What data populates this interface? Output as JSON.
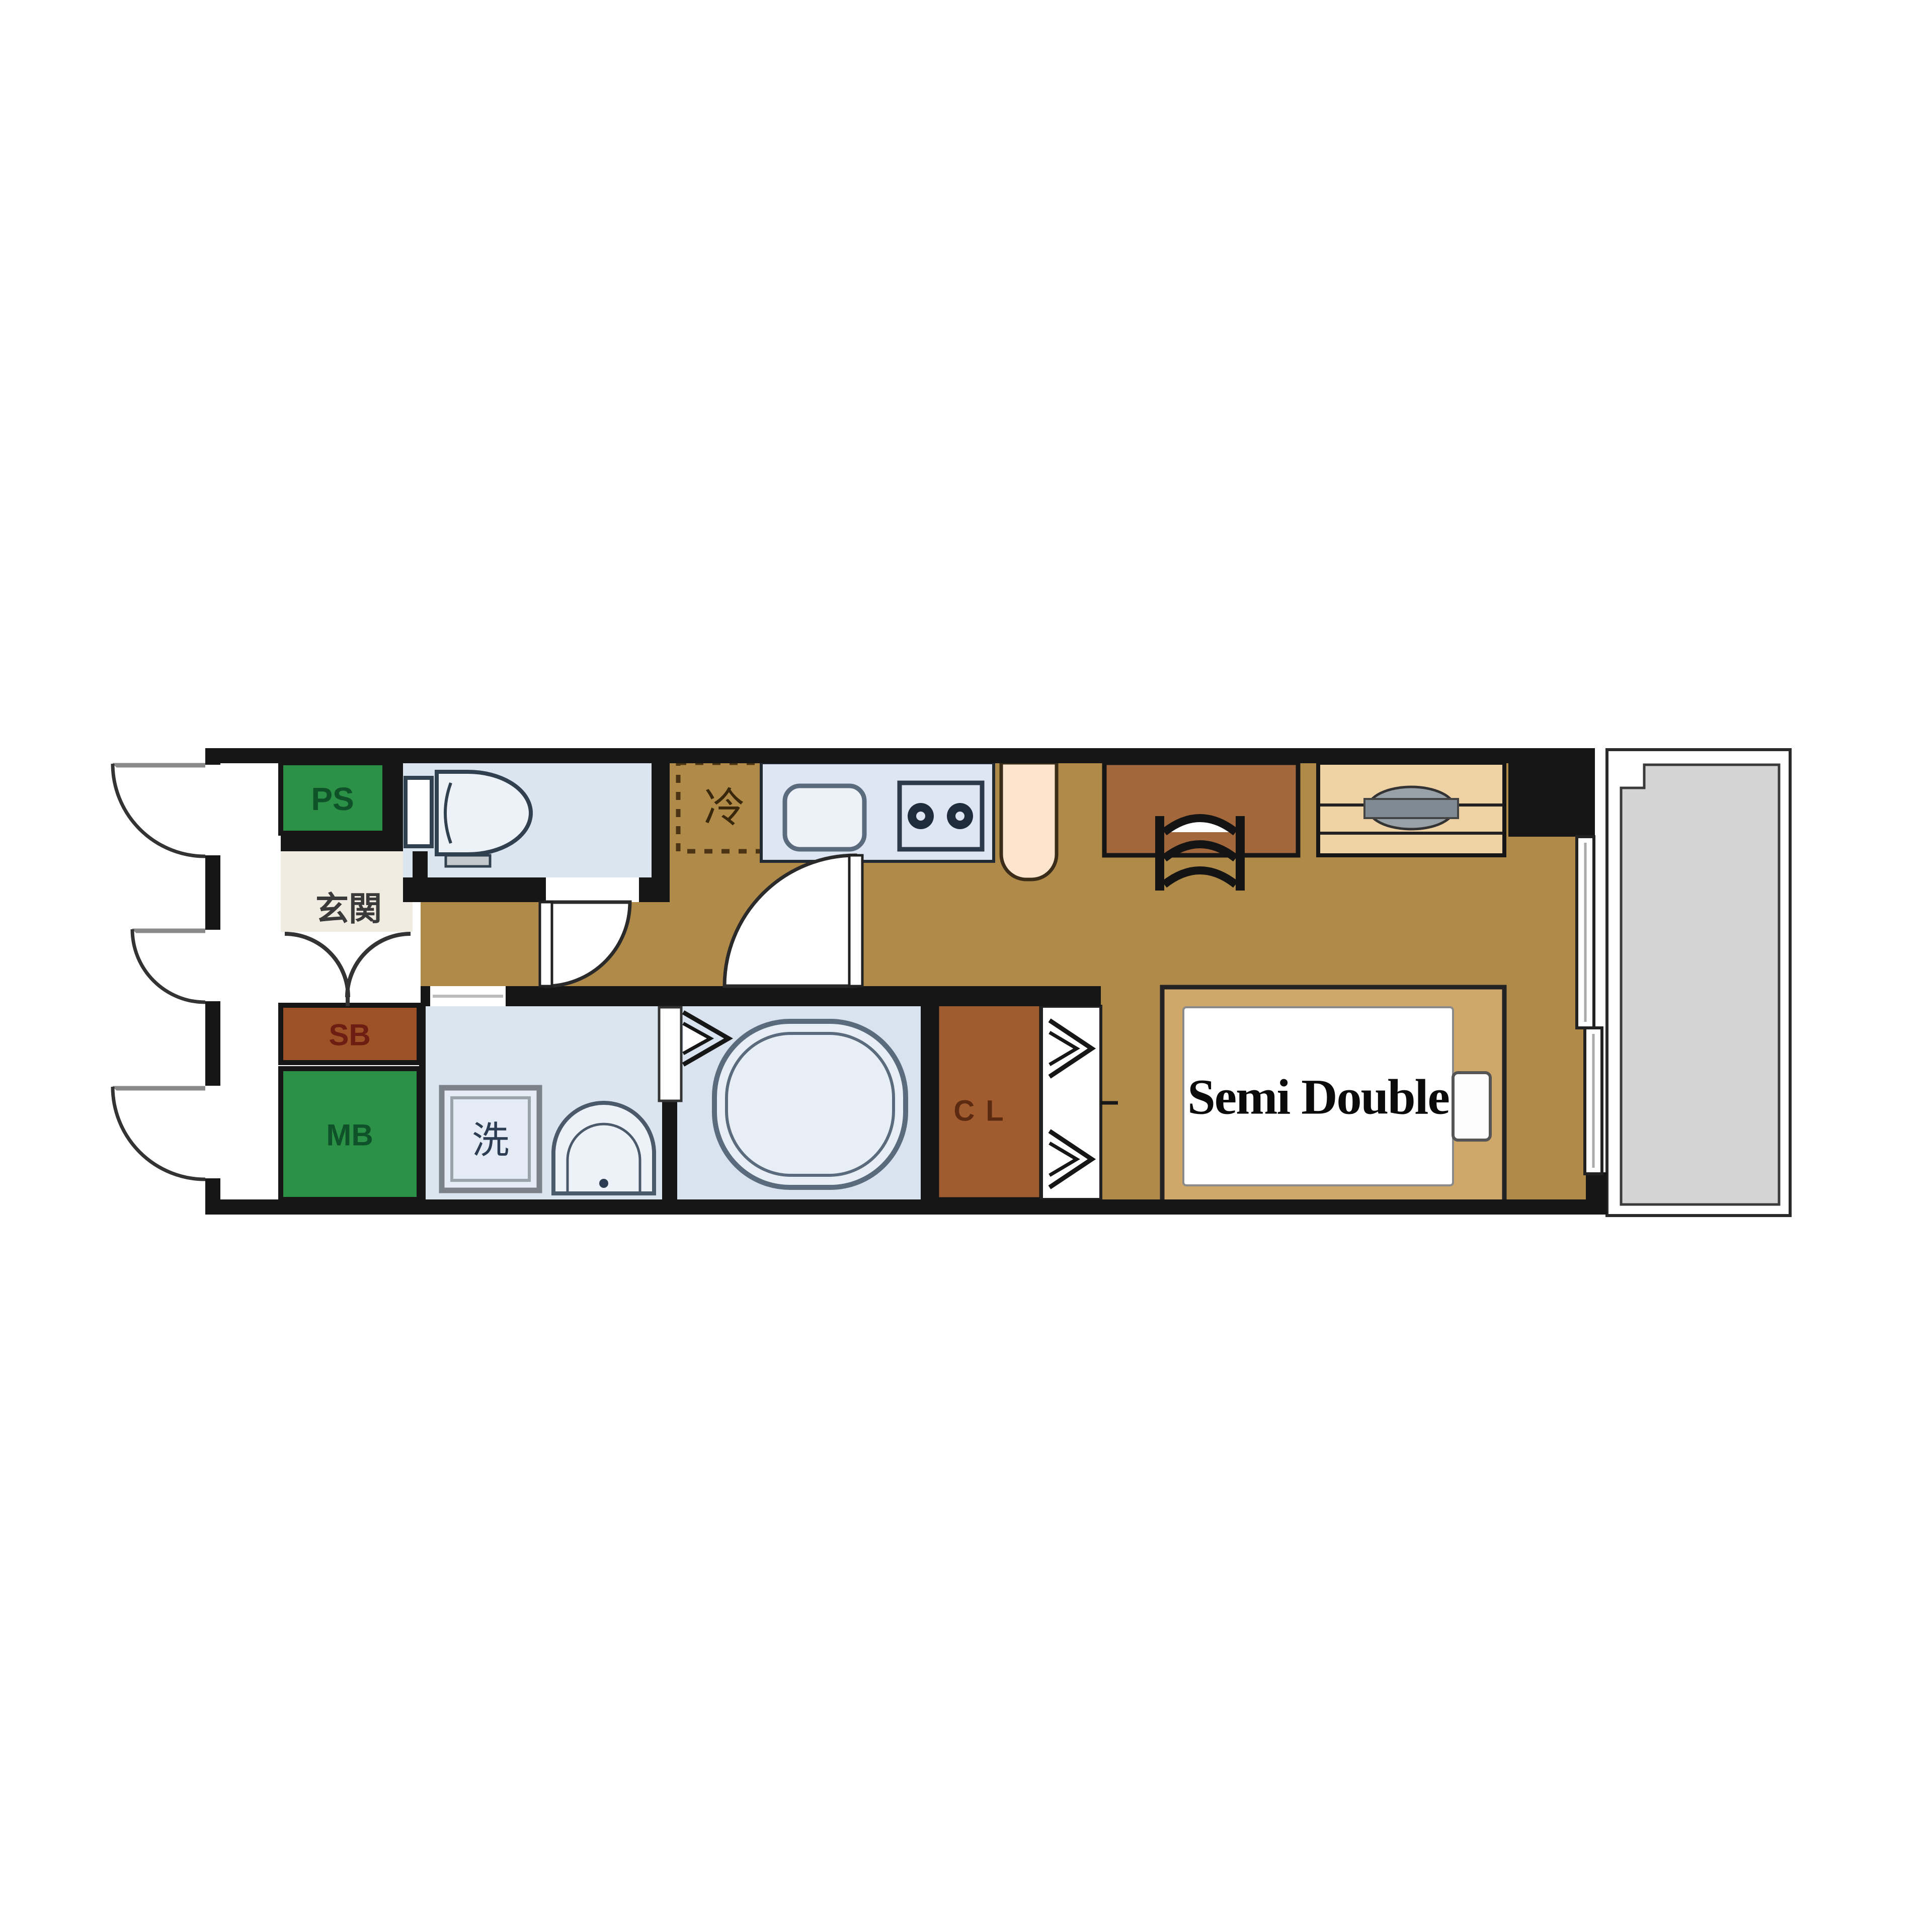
{
  "title": "studio-apartment-floor-plan",
  "labels": {
    "pipe_space": "PS",
    "entrance": "玄関",
    "shoe_box": "SB",
    "meter_box": "MB",
    "refrigerator": "冷",
    "washer": "洗",
    "closet": "CL",
    "bed": "Semi Double"
  },
  "colors": {
    "wall": "#161616",
    "floor_wood": "#b08a49",
    "floor_genkan": "#f0ece2",
    "room_blue": "#dbe5f0",
    "bath_blue": "#d9e3ef",
    "counter_blue": "#dde6f2",
    "fixture_white": "#edf2f8",
    "green_box": "#2b9147",
    "green_text": "#0f5128",
    "sb_brown": "#9d5126",
    "sb_text": "#6e1d12",
    "cl_brown": "#a05c2e",
    "cl_text": "#5c2a10",
    "desk_brown": "#a2683c",
    "bed_frame": "#cfa768",
    "tv_board": "#eed2a4",
    "tv_gray": "#98a0a8",
    "peach": "#fce4cd",
    "balcony_gray": "#d4d4d4",
    "dash_brown": "#4a3414",
    "label_dark": "#3a3a3a",
    "wash_text": "#2c3c52",
    "fridge_text": "#3a280c"
  }
}
